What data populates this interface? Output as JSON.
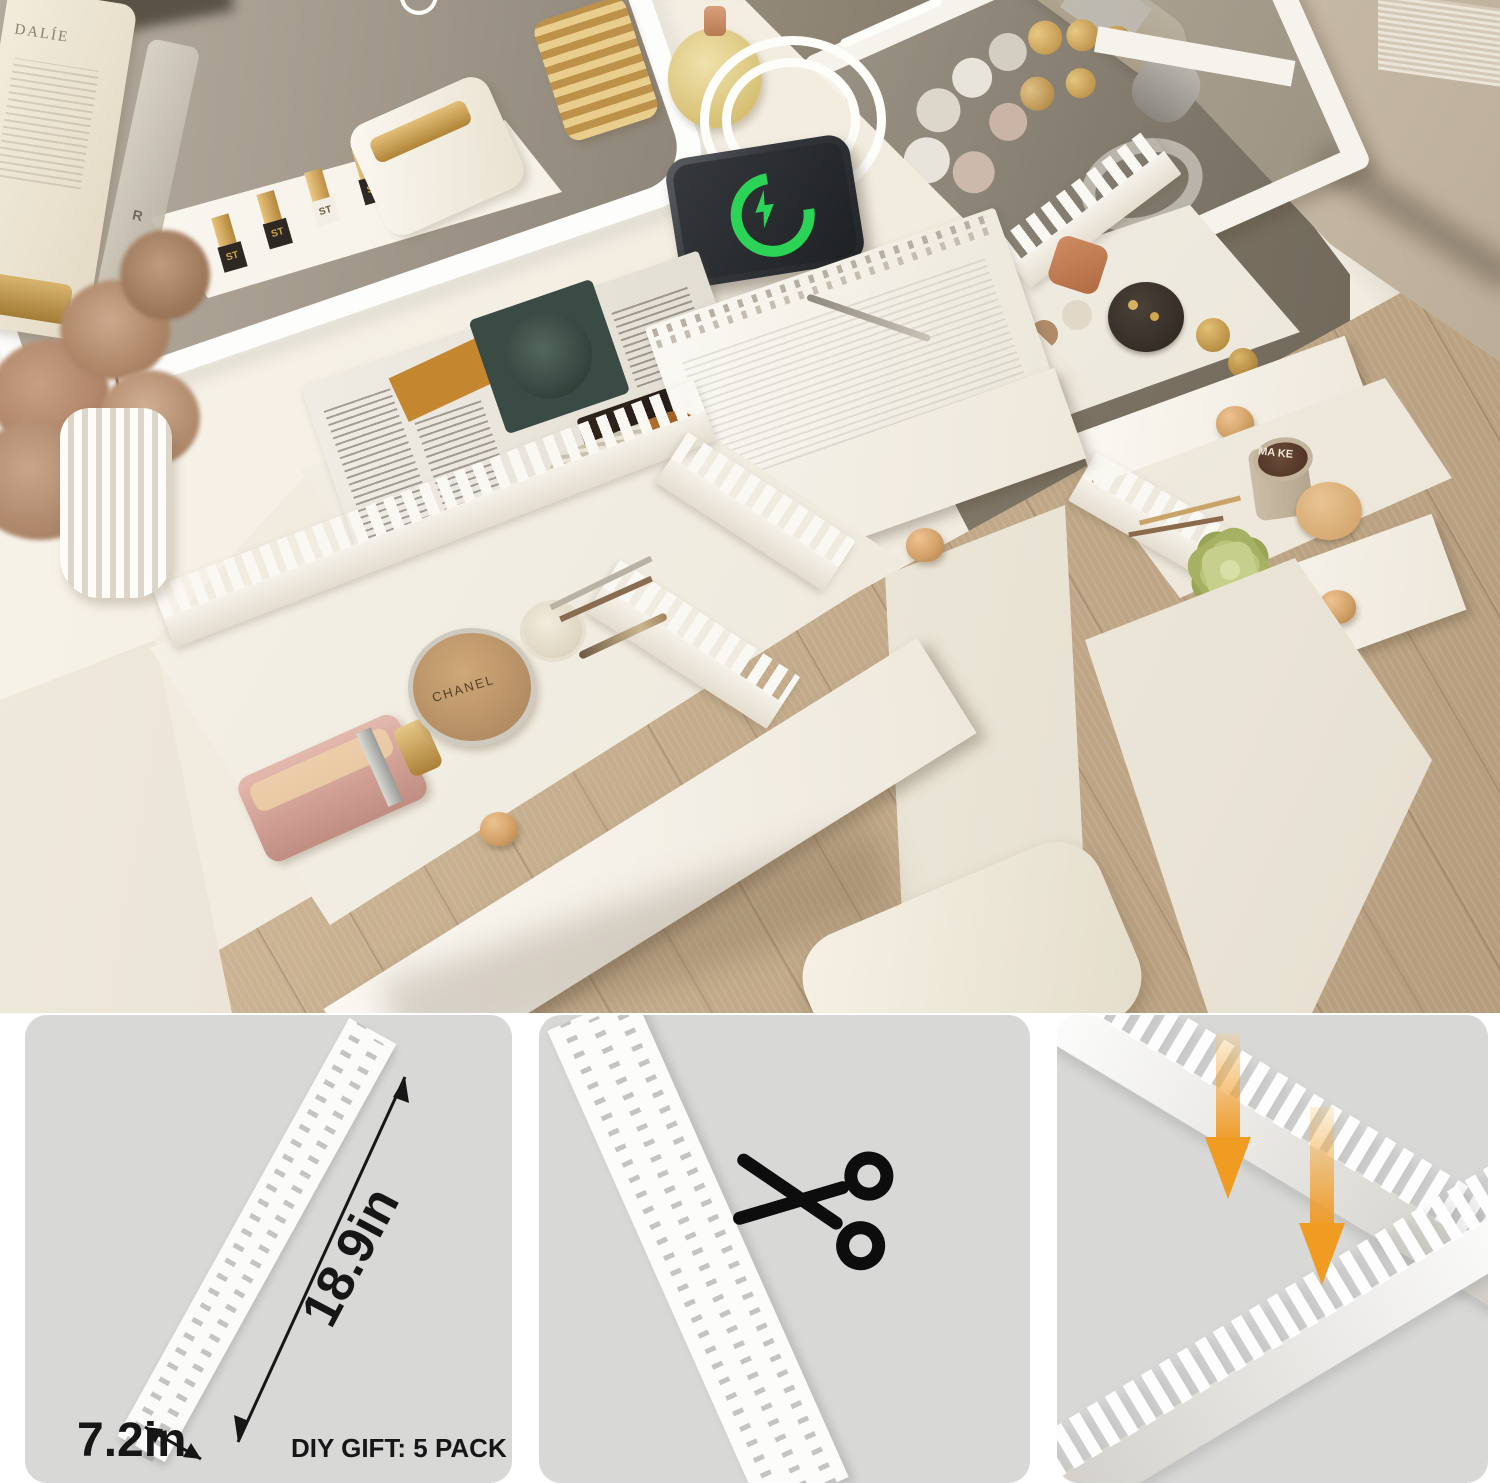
{
  "meta": {
    "kind": "product-photo-with-guide-panels",
    "width": 1500,
    "height": 1483
  },
  "colors": {
    "panel_bg": "#d8d8d7",
    "accent_orange": "#f09c23",
    "charge_green": "#2bd356",
    "wood_floor": "#c6ae8e",
    "wall_taupe": "#8a8072",
    "sofa_beige": "#d0c4b0",
    "desk_cream": "#f1ebe0",
    "furniture_white": "#faf7f1",
    "knob_wood": "#d3a269",
    "dimension_text": "#161616"
  },
  "scene": {
    "mirror": {
      "name": "led-mirror-with-touch-switch"
    },
    "shelf_lipsticks": [
      "ST",
      "ST",
      "ST",
      "ST",
      "ST"
    ],
    "tube_label": "DALÍE",
    "bottle_label": "R",
    "phone_status": "wireless-charging",
    "left_drawer": {
      "compact_label": "CHANEL"
    },
    "right_lower_drawer": {
      "jar_label": "MA KE"
    }
  },
  "panels": {
    "size_guide": {
      "length": "18.9in",
      "width": "7.2in",
      "note": "DIY GIFT: 5 PACK"
    },
    "cut_guide": {
      "icon": "scissors-icon"
    },
    "assembly_guide": {
      "icon": "down-arrow-icon",
      "arrow_count": 2
    }
  }
}
